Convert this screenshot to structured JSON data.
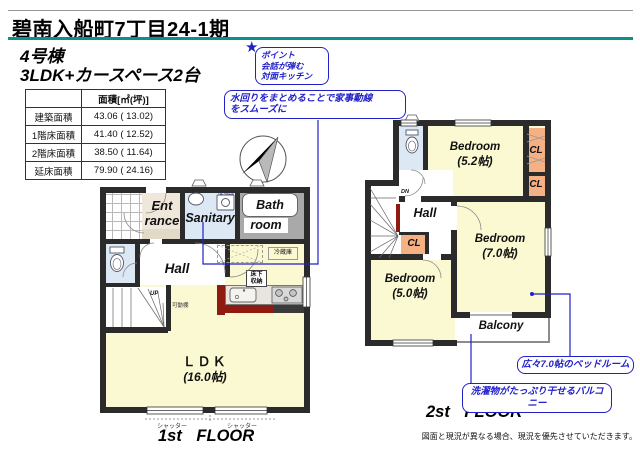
{
  "header": {
    "title": "碧南入船町7丁目24-1期",
    "building": "4号棟",
    "plan_type": "3LDK+カースペース2台"
  },
  "area_table": {
    "col_header": "面積[㎡(坪)]",
    "rows": [
      {
        "label": "建築面積",
        "value": "43.06 ( 13.02)"
      },
      {
        "label": "1階床面積",
        "value": "41.40 ( 12.52)"
      },
      {
        "label": "2階床面積",
        "value": "38.50 ( 11.64)"
      },
      {
        "label": "延床面積",
        "value": "79.90 ( 24.16)"
      }
    ]
  },
  "callouts": {
    "star": "★",
    "point_line1": "ポイント",
    "point_line2": "会話が弾む",
    "point_line3": "対面キッチン",
    "mizumawari_line1": "水回りをまとめることで家事動線",
    "mizumawari_line2": "をスムーズに",
    "bedroom7": "広々7.0帖のベッドルーム",
    "balcony": "洗濯物がたっぷり干せるバルコニー"
  },
  "floor1": {
    "caption": "1st FLOOR",
    "rooms": {
      "entrance_line1": "Ent",
      "entrance_line2": "rance",
      "sanitary": "Sanitary",
      "bath_line1": "Bath",
      "bath_line2": "room",
      "hall": "Hall",
      "ldk": "ＬＤＫ",
      "ldk_size": "(16.0帖)"
    },
    "labels": {
      "up": "UP",
      "washer": "洗濯機",
      "fridge": "冷蔵庫",
      "floor_storage_line1": "床下",
      "floor_storage_line2": "収納",
      "movable_shelf": "可動棚",
      "shutter": "シャッター"
    }
  },
  "floor2": {
    "caption": "2st FLOOR",
    "rooms": {
      "bedroom": "Bedroom",
      "bedroom52_size": "(5.2帖)",
      "bedroom70_size": "(7.0帖)",
      "bedroom50_size": "(5.0帖)",
      "hall": "Hall",
      "balcony": "Balcony",
      "closet": "CL"
    },
    "labels": {
      "dn": "DN"
    }
  },
  "footer": {
    "disclaimer": "図面と現況が異なる場合、現況を優先させていただきます。"
  },
  "colors": {
    "accent_teal": "#0e8f8c",
    "callout_blue": "#2121c8",
    "wall": "#2b2b2b",
    "room_yellow": "#fbf9d2",
    "closet_orange": "#f5b183",
    "wet_area_blue": "#dce9f5",
    "kitchen_red": "#8e1a10",
    "bath_gray": "#a9a9a9",
    "entrance_tan": "#efe8da"
  }
}
